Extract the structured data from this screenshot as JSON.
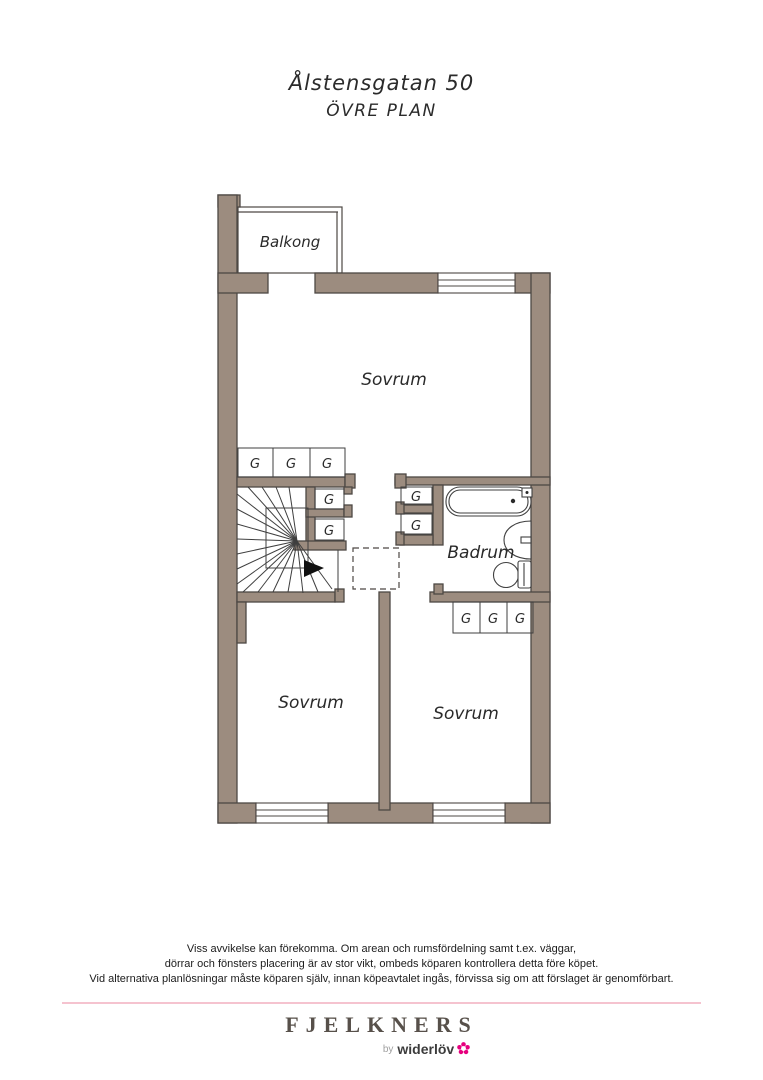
{
  "page": {
    "title": "Ålstensgatan 50",
    "subtitle": "ÖVRE PLAN"
  },
  "plan": {
    "rooms": {
      "balcony": "Balkong",
      "bedroom_top": "Sovrum",
      "bedroom_left": "Sovrum",
      "bedroom_right": "Sovrum",
      "bathroom": "Badrum"
    },
    "wardrobe_label": "G",
    "colors": {
      "wall_fill": "#9c8c7f",
      "wall_stroke": "#4d4844"
    }
  },
  "footer": {
    "disclaimer_lines": [
      "Viss avvikelse kan förekomma. Om arean och rumsfördelning samt t.ex. väggar,",
      "dörrar och fönsters placering är av stor vikt, ombeds köparen kontrollera detta före köpet.",
      "Vid alternativa planlösningar måste köparen själv, innan köpeavtalet ingås, förvissa sig om att förslaget är genomförbart."
    ],
    "divider_color": "#f5c3cf",
    "brand": "FJELKNERS",
    "byline_prefix": "by",
    "byline_name": "widerlöv",
    "brand_accent": "#e6007e"
  }
}
